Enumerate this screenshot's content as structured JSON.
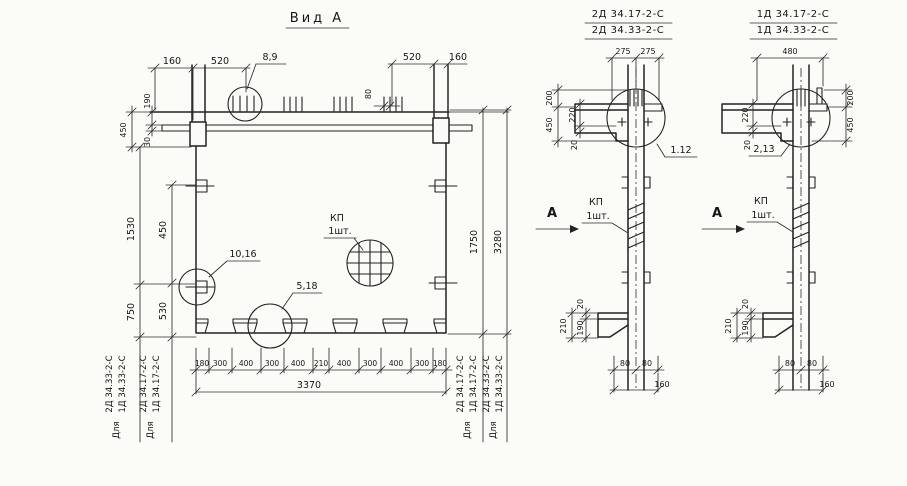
{
  "view_a": {
    "title": "Вид А",
    "dims": {
      "top_left_160": "160",
      "top_left_520": "520",
      "top_right_520": "520",
      "top_right_160": "160",
      "beam_190": "190",
      "beam_30": "30",
      "beam_450": "450",
      "rebar_80": "80",
      "left_1530": "1530",
      "left_450": "450",
      "left_750": "750",
      "left_530": "530",
      "right_1750": "1750",
      "right_3280": "3280",
      "bottom_segments": [
        "180",
        "300",
        "400",
        "300",
        "400",
        "210",
        "400",
        "300",
        "400",
        "300",
        "180"
      ],
      "bottom_total": "3370"
    },
    "callouts": {
      "top": "8,9",
      "side": "10,16",
      "notch": "5,18"
    },
    "kp": {
      "label": "КП",
      "qty": "1шт."
    },
    "for_labels": {
      "left_outer": {
        "word": "Для",
        "line1": "2Д 34.33-2-С",
        "line2": "1Д 34.33-2-С"
      },
      "left_inner": {
        "word": "Для",
        "line1": "2Д 34.17-2-С",
        "line2": "1Д 34.17-2-С"
      },
      "right_inner": {
        "word": "Для",
        "line1": "2Д 34.17-2-С",
        "line2": "1Д 34.17-2-С"
      },
      "right_outer": {
        "word": "Для",
        "line1": "2Д 34.33-2-С",
        "line2": "1Д 34.33-2-С"
      }
    }
  },
  "section_left": {
    "code_top": "2Д 34.17-2-С",
    "code_bottom": "2Д 34.33-2-С",
    "callout": "1.12",
    "letter": "А",
    "kp": {
      "label": "КП",
      "qty": "1шт."
    },
    "dims": {
      "d275a": "275",
      "d275b": "275",
      "d200": "200",
      "d450": "450",
      "d220": "220",
      "d20": "20",
      "f210": "210",
      "f20": "20",
      "f190": "190",
      "b80a": "80",
      "b80b": "80",
      "b160": "160"
    }
  },
  "section_right": {
    "code_top": "1Д 34.17-2-С",
    "code_bottom": "1Д 34.33-2-С",
    "callout": "2,13",
    "letter": "А",
    "kp": {
      "label": "КП",
      "qty": "1шт."
    },
    "dims": {
      "d480": "480",
      "d220": "220",
      "d20": "20",
      "d200": "200",
      "d450": "450",
      "f210": "210",
      "f20": "20",
      "f190": "190",
      "b80a": "80",
      "b80b": "80",
      "b160": "160"
    }
  }
}
